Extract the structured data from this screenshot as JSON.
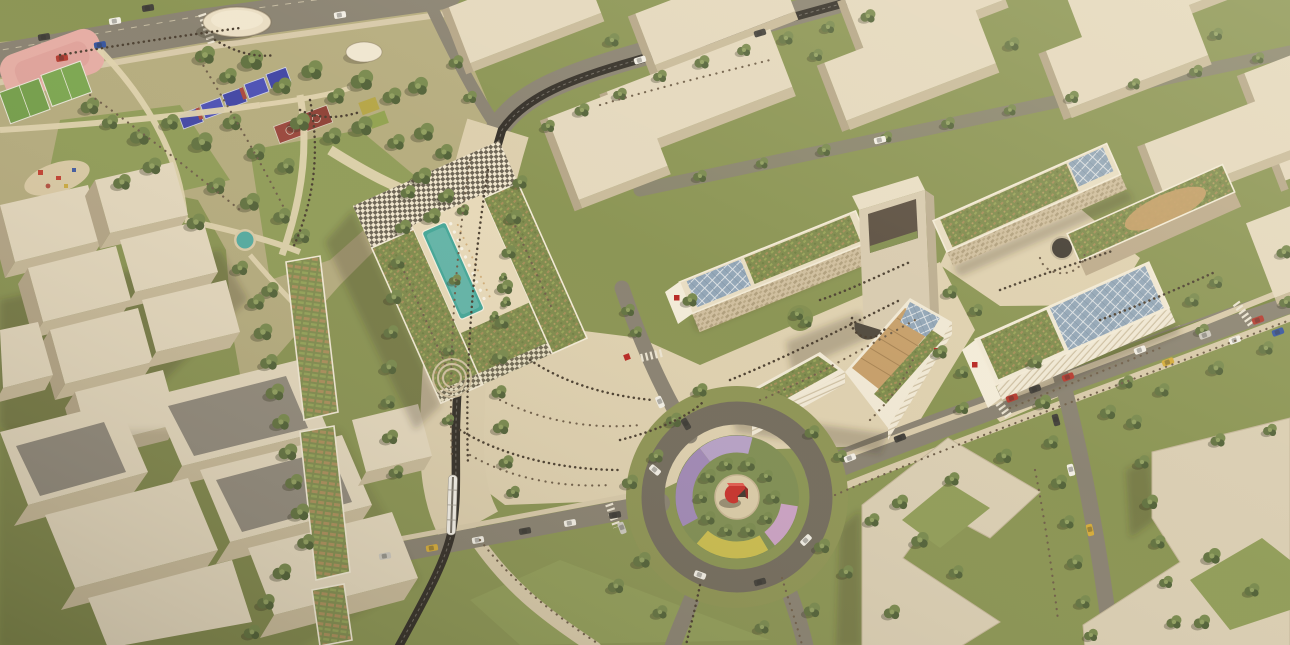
{
  "scene": {
    "title": "Aerial rendering of a mixed-use campus masterplan",
    "description": "Bird's-eye architectural visualization with a sports park, a perimeter block with checkerboard facade and rooftop pool courtyard, a tram boulevard, campus buildings with photovoltaic and garden roofs, a landscaped roundabout with a red U-shaped sculpture, and surrounding beige massing blocks.",
    "lighting": "low warm sun from upper right, long shadows to lower left",
    "landmarks": [
      {
        "id": "sports-park",
        "label": "park with running track, soccer fields, blue padel courts, red basketball courts and oval pavilion"
      },
      {
        "id": "courtyard-building",
        "label": "perimeter block, checkerboard facade, roof terraces, courtyard pool with umbrellas"
      },
      {
        "id": "tram-boulevard",
        "label": "pedestrian boulevard with dark tram line and tree rows"
      },
      {
        "id": "civic-plaza",
        "label": "paved plaza with circular amphitheatre and crowds"
      },
      {
        "id": "campus-slab",
        "label": "campus slab with solar roof, garden roof and red logo end wall"
      },
      {
        "id": "portal-tower",
        "label": "tower with rectangular portal opening"
      },
      {
        "id": "chevron-building",
        "label": "chevron building with rooftop timber amphitheatre and red logo"
      },
      {
        "id": "right-campus",
        "label": "second campus cluster with textured facades, garden and solar roofs, circular pond"
      },
      {
        "id": "striped-building",
        "label": "white banded building with large photovoltaic roof"
      },
      {
        "id": "roundabout",
        "label": "roundabout with flower rings, tree ring and red U sculpture"
      },
      {
        "id": "context-blocks",
        "label": "plain beige massing blocks of the surrounding city"
      },
      {
        "id": "garden-roof-rows",
        "label": "row buildings with community garden roofs"
      },
      {
        "id": "roads",
        "label": "streets with cars, zebra crossings and green medians"
      },
      {
        "id": "pond",
        "label": "small round turquoise pool in the park"
      }
    ]
  },
  "palette": {
    "grass": "#86914f",
    "park_ground": "#b3aa7c",
    "paving": "#ddcfae",
    "road": "#857e6e",
    "tram": "#2c2822",
    "block_top": "#e3d7bd",
    "block_face": "#c6b898",
    "white_wall": "#f2ebd9",
    "checker_dark": "#665e4f",
    "pool": "#3ea496",
    "pond": "#4fa9a0",
    "solar": "#8ea3b6",
    "green_roof": "#7a8748",
    "planter": "#a18a55",
    "wood_terrace": "#c49c66",
    "track_pink": "#e5aba3",
    "court_blue": "#3c41a4",
    "court_red": "#964238",
    "court_yellow": "#b3a342",
    "flower_purple": "#9d85b5",
    "flower_lavender": "#b49ec6",
    "flower_yellow": "#c9bb4a",
    "flower_pink": "#c99fc4",
    "sculpture_red": "#c62b26",
    "logo_red": "#b5211d",
    "tree_green": "#74864a"
  }
}
